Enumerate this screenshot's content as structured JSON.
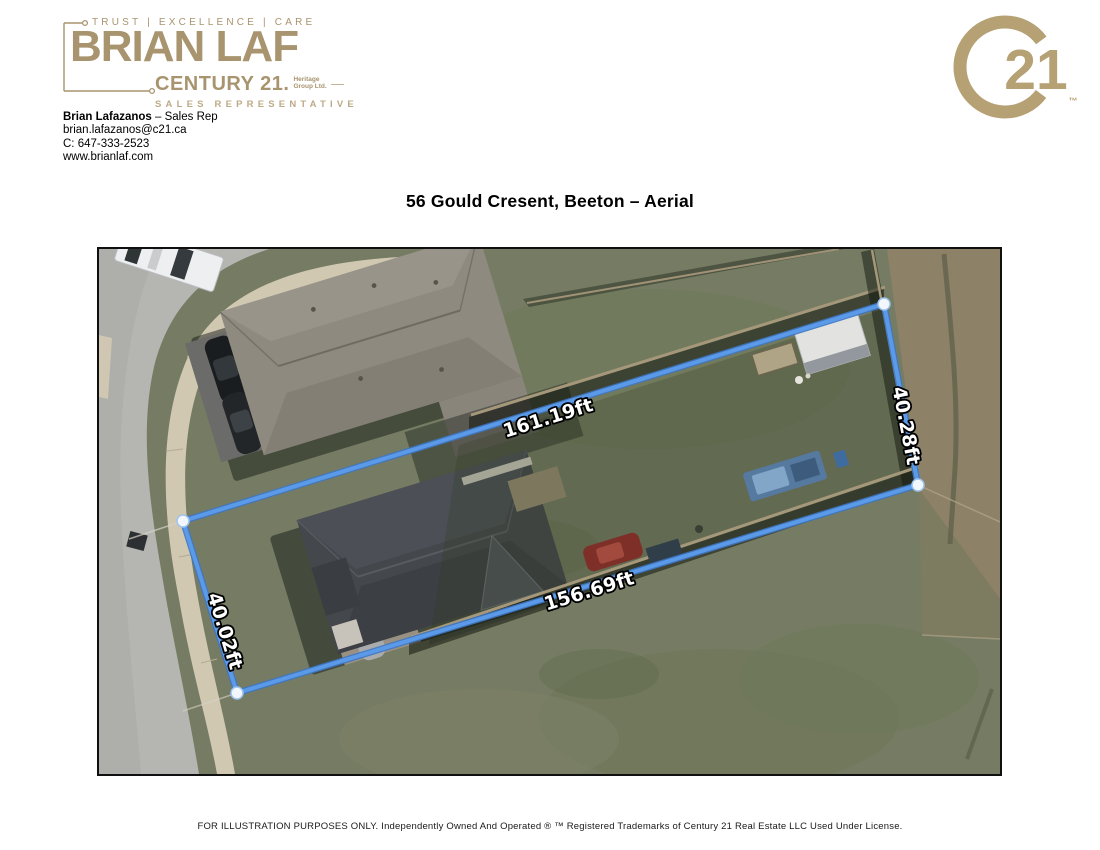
{
  "branding": {
    "tagline": "TRUST  |  EXCELLENCE  |  CARE",
    "agent_logo_name": "BRIAN LAF",
    "brand_name": "CENTURY 21.",
    "brokerage_line1": "Heritage",
    "brokerage_line2": "Group Ltd.",
    "role": "SALES REPRESENTATIVE",
    "seal_number": "21",
    "seal_trademark": "™",
    "brand_gold": "#A8946E",
    "seal_gold": "#B5A173"
  },
  "contact": {
    "name": "Brian Lafazanos",
    "name_suffix": " – Sales Rep",
    "email": "brian.lafazanos@c21.ca",
    "phone": "C: 647-333-2523",
    "website": "www.brianlaf.com"
  },
  "page": {
    "title": "56 Gould Cresent, Beeton – Aerial"
  },
  "aerial": {
    "boundary_color": "#4C8DE2",
    "corner_marker_color": "#F2F7FD",
    "measurements": {
      "top": "161.19ft",
      "right": "40.28ft",
      "bottom": "156.69ft",
      "left": "40.02ft"
    }
  },
  "footer": {
    "disclaimer": "FOR ILLUSTRATION PURPOSES ONLY. Independently Owned And Operated ® ™ Registered Trademarks of Century 21 Real Estate LLC Used Under License."
  }
}
